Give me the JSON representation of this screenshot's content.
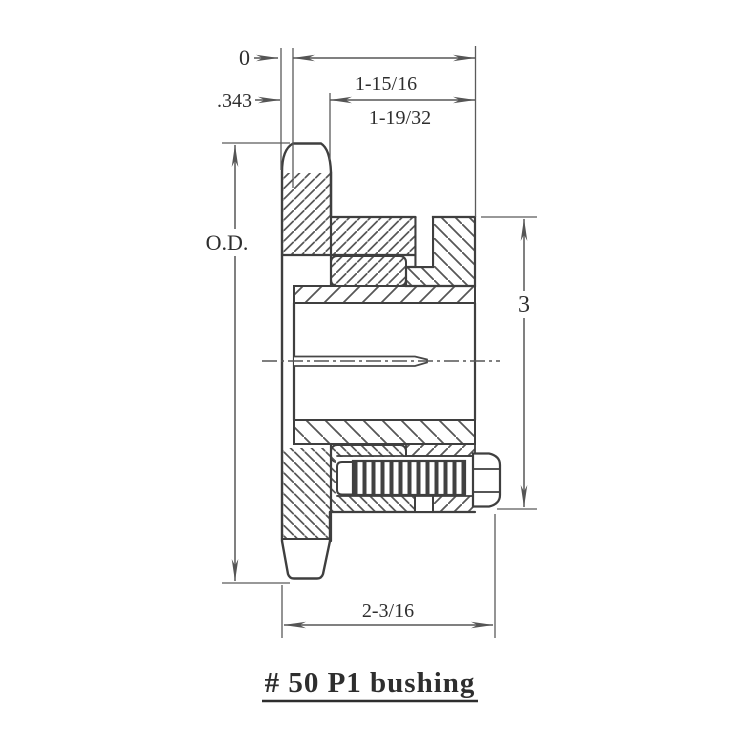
{
  "drawing": {
    "title": "# 50 P1 bushing",
    "dimensions": {
      "datum_zero": "0",
      "plate_offset": ".343",
      "bushing_length": "1-15/16",
      "taper_length": "1-19/32",
      "outer_diameter_label": "O.D.",
      "flange_diameter": "3",
      "overall_width": "2-3/16"
    },
    "colors": {
      "outline": "#3f3f3f",
      "hatch": "#555555",
      "dimension": "#5a5a5a",
      "text": "#2e2e2e"
    }
  }
}
